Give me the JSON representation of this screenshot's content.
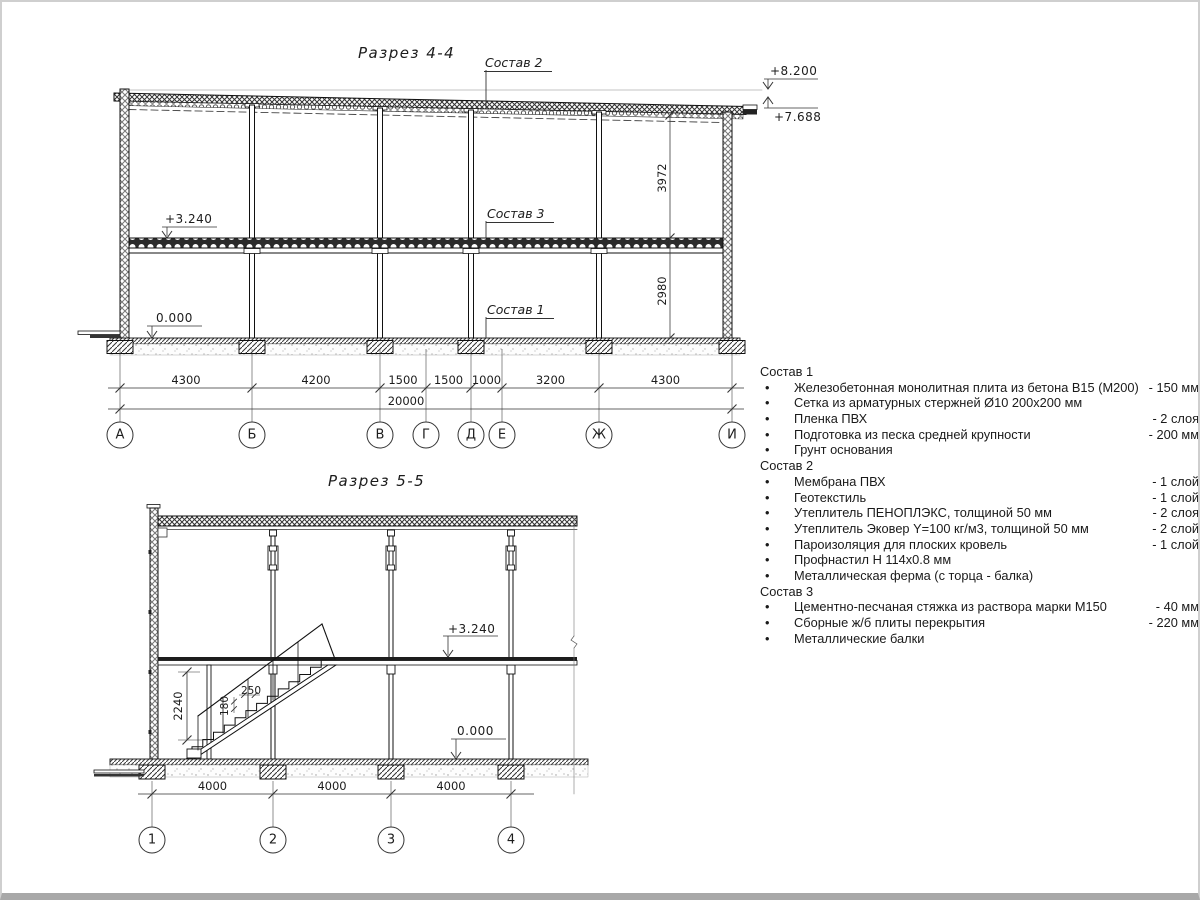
{
  "page": {
    "background": "#ffffff",
    "border_color": "#cfcfcf",
    "line_color": "#1c1c1c"
  },
  "section44": {
    "title": "Разрез 4-4",
    "axes": [
      "А",
      "Б",
      "В",
      "Г",
      "Д",
      "Е",
      "Ж",
      "И"
    ],
    "span_dims": [
      "4300",
      "4200",
      "1500",
      "1500",
      "1000",
      "3200",
      "4300"
    ],
    "total_dim": "20000",
    "height_dims": [
      "3972",
      "2980"
    ],
    "elevations": {
      "roof_high": "+8.200",
      "roof_low": "+7.688",
      "floor": "+3.240",
      "ground": "0.000"
    },
    "labels": {
      "comp1": "Состав 1",
      "comp2": "Состав 2",
      "comp3": "Состав 3"
    }
  },
  "section55": {
    "title": "Разрез 5-5",
    "axes": [
      "1",
      "2",
      "3",
      "4"
    ],
    "span_dims": [
      "4000",
      "4000",
      "4000"
    ],
    "elevations": {
      "floor": "+3.240",
      "ground": "0.000"
    },
    "stair_dims": {
      "height": "2240",
      "tread": "250",
      "riser": "180"
    }
  },
  "compositions": [
    {
      "title": "Состав 1",
      "items": [
        {
          "text": "Железобетонная монолитная плита из бетона В15 (М200)",
          "value": "- 150 мм"
        },
        {
          "text": "Сетка из арматурных стержней Ø10 200x200 мм",
          "value": ""
        },
        {
          "text": "Пленка ПВХ",
          "value": "- 2 слоя"
        },
        {
          "text": "Подготовка из песка средней крупности",
          "value": "- 200 мм"
        },
        {
          "text": "Грунт основания",
          "value": ""
        }
      ]
    },
    {
      "title": "Состав 2",
      "items": [
        {
          "text": "Мембрана ПВХ",
          "value": "- 1 слой"
        },
        {
          "text": "Геотекстиль",
          "value": "- 1 слой"
        },
        {
          "text": "Утеплитель ПЕНОПЛЭКС, толщиной 50 мм",
          "value": "- 2 слоя"
        },
        {
          "text": "Утеплитель Эковер Y=100 кг/м3, толщиной 50 мм",
          "value": "- 2 слой"
        },
        {
          "text": "Пароизоляция для плоских кровель",
          "value": "- 1 слой"
        },
        {
          "text": "Профнастил Н 114x0.8 мм",
          "value": ""
        },
        {
          "text": "Металлическая ферма (с торца - балка)",
          "value": ""
        }
      ]
    },
    {
      "title": "Состав 3",
      "items": [
        {
          "text": "Цементно-песчаная стяжка из раствора марки М150",
          "value": "- 40 мм"
        },
        {
          "text": "Сборные ж/б плиты перекрытия",
          "value": "- 220 мм"
        },
        {
          "text": "Металлические балки",
          "value": ""
        }
      ]
    }
  ]
}
